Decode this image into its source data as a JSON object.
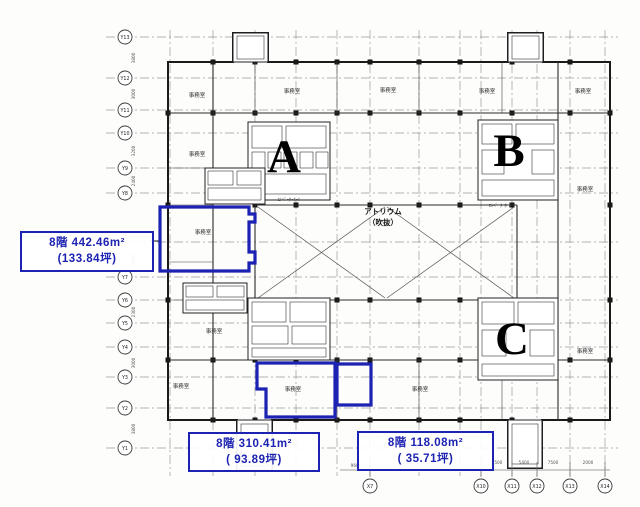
{
  "annotations": {
    "left": {
      "line1": "8階  442.46m²",
      "line2": "(133.84坪)"
    },
    "bottom_center": {
      "line1": "8階  310.41m²",
      "line2": "( 93.89坪)"
    },
    "bottom_right": {
      "line1": "8階  118.08m²",
      "line2": "( 35.71坪)"
    }
  },
  "plan": {
    "atrium_label": [
      "アトリウム",
      "（吹抜）"
    ],
    "section_letters": [
      {
        "t": "A",
        "x": 284,
        "y": 172
      },
      {
        "t": "B",
        "x": 509,
        "y": 166
      },
      {
        "t": "C",
        "x": 512,
        "y": 354
      }
    ],
    "y_axis_bubbles": [
      {
        "label": "Y13",
        "y": 37
      },
      {
        "label": "Y12",
        "y": 78
      },
      {
        "label": "Y11",
        "y": 110
      },
      {
        "label": "Y10",
        "y": 133
      },
      {
        "label": "Y9",
        "y": 168
      },
      {
        "label": "Y8",
        "y": 193
      },
      {
        "label": "Y7",
        "y": 277
      },
      {
        "label": "Y6",
        "y": 300
      },
      {
        "label": "Y5",
        "y": 323
      },
      {
        "label": "Y4",
        "y": 347
      },
      {
        "label": "Y3",
        "y": 377
      },
      {
        "label": "Y2",
        "y": 408
      },
      {
        "label": "Y1",
        "y": 448
      }
    ],
    "x_axis_bubbles": [
      {
        "label": "X7",
        "x": 370
      },
      {
        "label": "X10",
        "x": 481
      },
      {
        "label": "X11",
        "x": 512
      },
      {
        "label": "X12",
        "x": 537
      },
      {
        "label": "X13",
        "x": 570
      },
      {
        "label": "X14",
        "x": 605
      }
    ],
    "grid_x": [
      170,
      213,
      255,
      296,
      337,
      370,
      419,
      460,
      481,
      512,
      537,
      570,
      605
    ],
    "grid_y": [
      37,
      78,
      110,
      133,
      168,
      193,
      242,
      277,
      300,
      323,
      347,
      377,
      408,
      448
    ],
    "columns": [
      {
        "y": 62,
        "xs": [
          213,
          255,
          296,
          337,
          370,
          419,
          460,
          512,
          570
        ]
      },
      {
        "y": 113,
        "xs": [
          213,
          255,
          296,
          337,
          370,
          419,
          460,
          512,
          570
        ]
      },
      {
        "y": 205,
        "xs": [
          255,
          296,
          337,
          370,
          419,
          460,
          512
        ]
      },
      {
        "y": 300,
        "xs": [
          255,
          296,
          337,
          370,
          419,
          460,
          512
        ]
      },
      {
        "y": 360,
        "xs": [
          213,
          255,
          296,
          337,
          370,
          419,
          460,
          512,
          570
        ]
      },
      {
        "y": 420,
        "xs": [
          213,
          255,
          296,
          337,
          370,
          419,
          460,
          512,
          570
        ]
      },
      {
        "x": 168,
        "ys": [
          113,
          205,
          300,
          360
        ]
      },
      {
        "x": 610,
        "ys": [
          113,
          205,
          300,
          360
        ]
      }
    ],
    "room_labels": [
      {
        "t": "事務室",
        "x": 197,
        "y": 97
      },
      {
        "t": "事務室",
        "x": 292,
        "y": 93
      },
      {
        "t": "事務室",
        "x": 388,
        "y": 92
      },
      {
        "t": "事務室",
        "x": 487,
        "y": 93
      },
      {
        "t": "事務室",
        "x": 583,
        "y": 93
      },
      {
        "t": "事務室",
        "x": 197,
        "y": 156
      },
      {
        "t": "事務室",
        "x": 585,
        "y": 191
      },
      {
        "t": "事務室",
        "x": 203,
        "y": 234
      },
      {
        "t": "事務室",
        "x": 214,
        "y": 333
      },
      {
        "t": "事務室",
        "x": 181,
        "y": 388
      },
      {
        "t": "事務室",
        "x": 293,
        "y": 391
      },
      {
        "t": "事務室",
        "x": 420,
        "y": 391
      },
      {
        "t": "事務室",
        "x": 585,
        "y": 353
      }
    ],
    "elevator_labels": [
      {
        "t": "ｴﾚﾍﾞｰﾀｰﾎｰﾙ",
        "x": 289,
        "y": 201
      },
      {
        "t": "ｴﾚﾍﾞｰﾀｰﾎｰﾙ",
        "x": 500,
        "y": 207
      }
    ],
    "bottom_dims": [
      {
        "t": "9600",
        "x": 356,
        "y": 467
      },
      {
        "t": "4500",
        "x": 497,
        "y": 464
      },
      {
        "t": "5400",
        "x": 524,
        "y": 464
      },
      {
        "t": "7500",
        "x": 553,
        "y": 464
      },
      {
        "t": "2000",
        "x": 588,
        "y": 464
      }
    ],
    "left_dims": [
      {
        "t": "3800",
        "y": 58
      },
      {
        "t": "3000",
        "y": 94
      },
      {
        "t": "3200",
        "y": 151
      },
      {
        "t": "2400",
        "y": 181
      },
      {
        "t": "3000",
        "y": 260
      },
      {
        "t": "2300",
        "y": 312
      },
      {
        "t": "3000",
        "y": 363
      },
      {
        "t": "3800",
        "y": 429
      }
    ],
    "highlight_regions": [
      {
        "name": "highlight-area-442",
        "points": "160,207 249,207 249,214 255,214 255,222 249,222 249,252 255,252 255,263 249,263 249,271 160,271"
      },
      {
        "name": "highlight-area-310",
        "points": "257,363 335,363 335,417 266,417 266,389 257,389"
      },
      {
        "name": "highlight-area-118",
        "points": "337,364 371,364 371,405 337,405"
      }
    ],
    "colors": {
      "highlight": "#1c22b2",
      "wall": "#1a1a1a",
      "grid": "#9a9a9a"
    }
  }
}
